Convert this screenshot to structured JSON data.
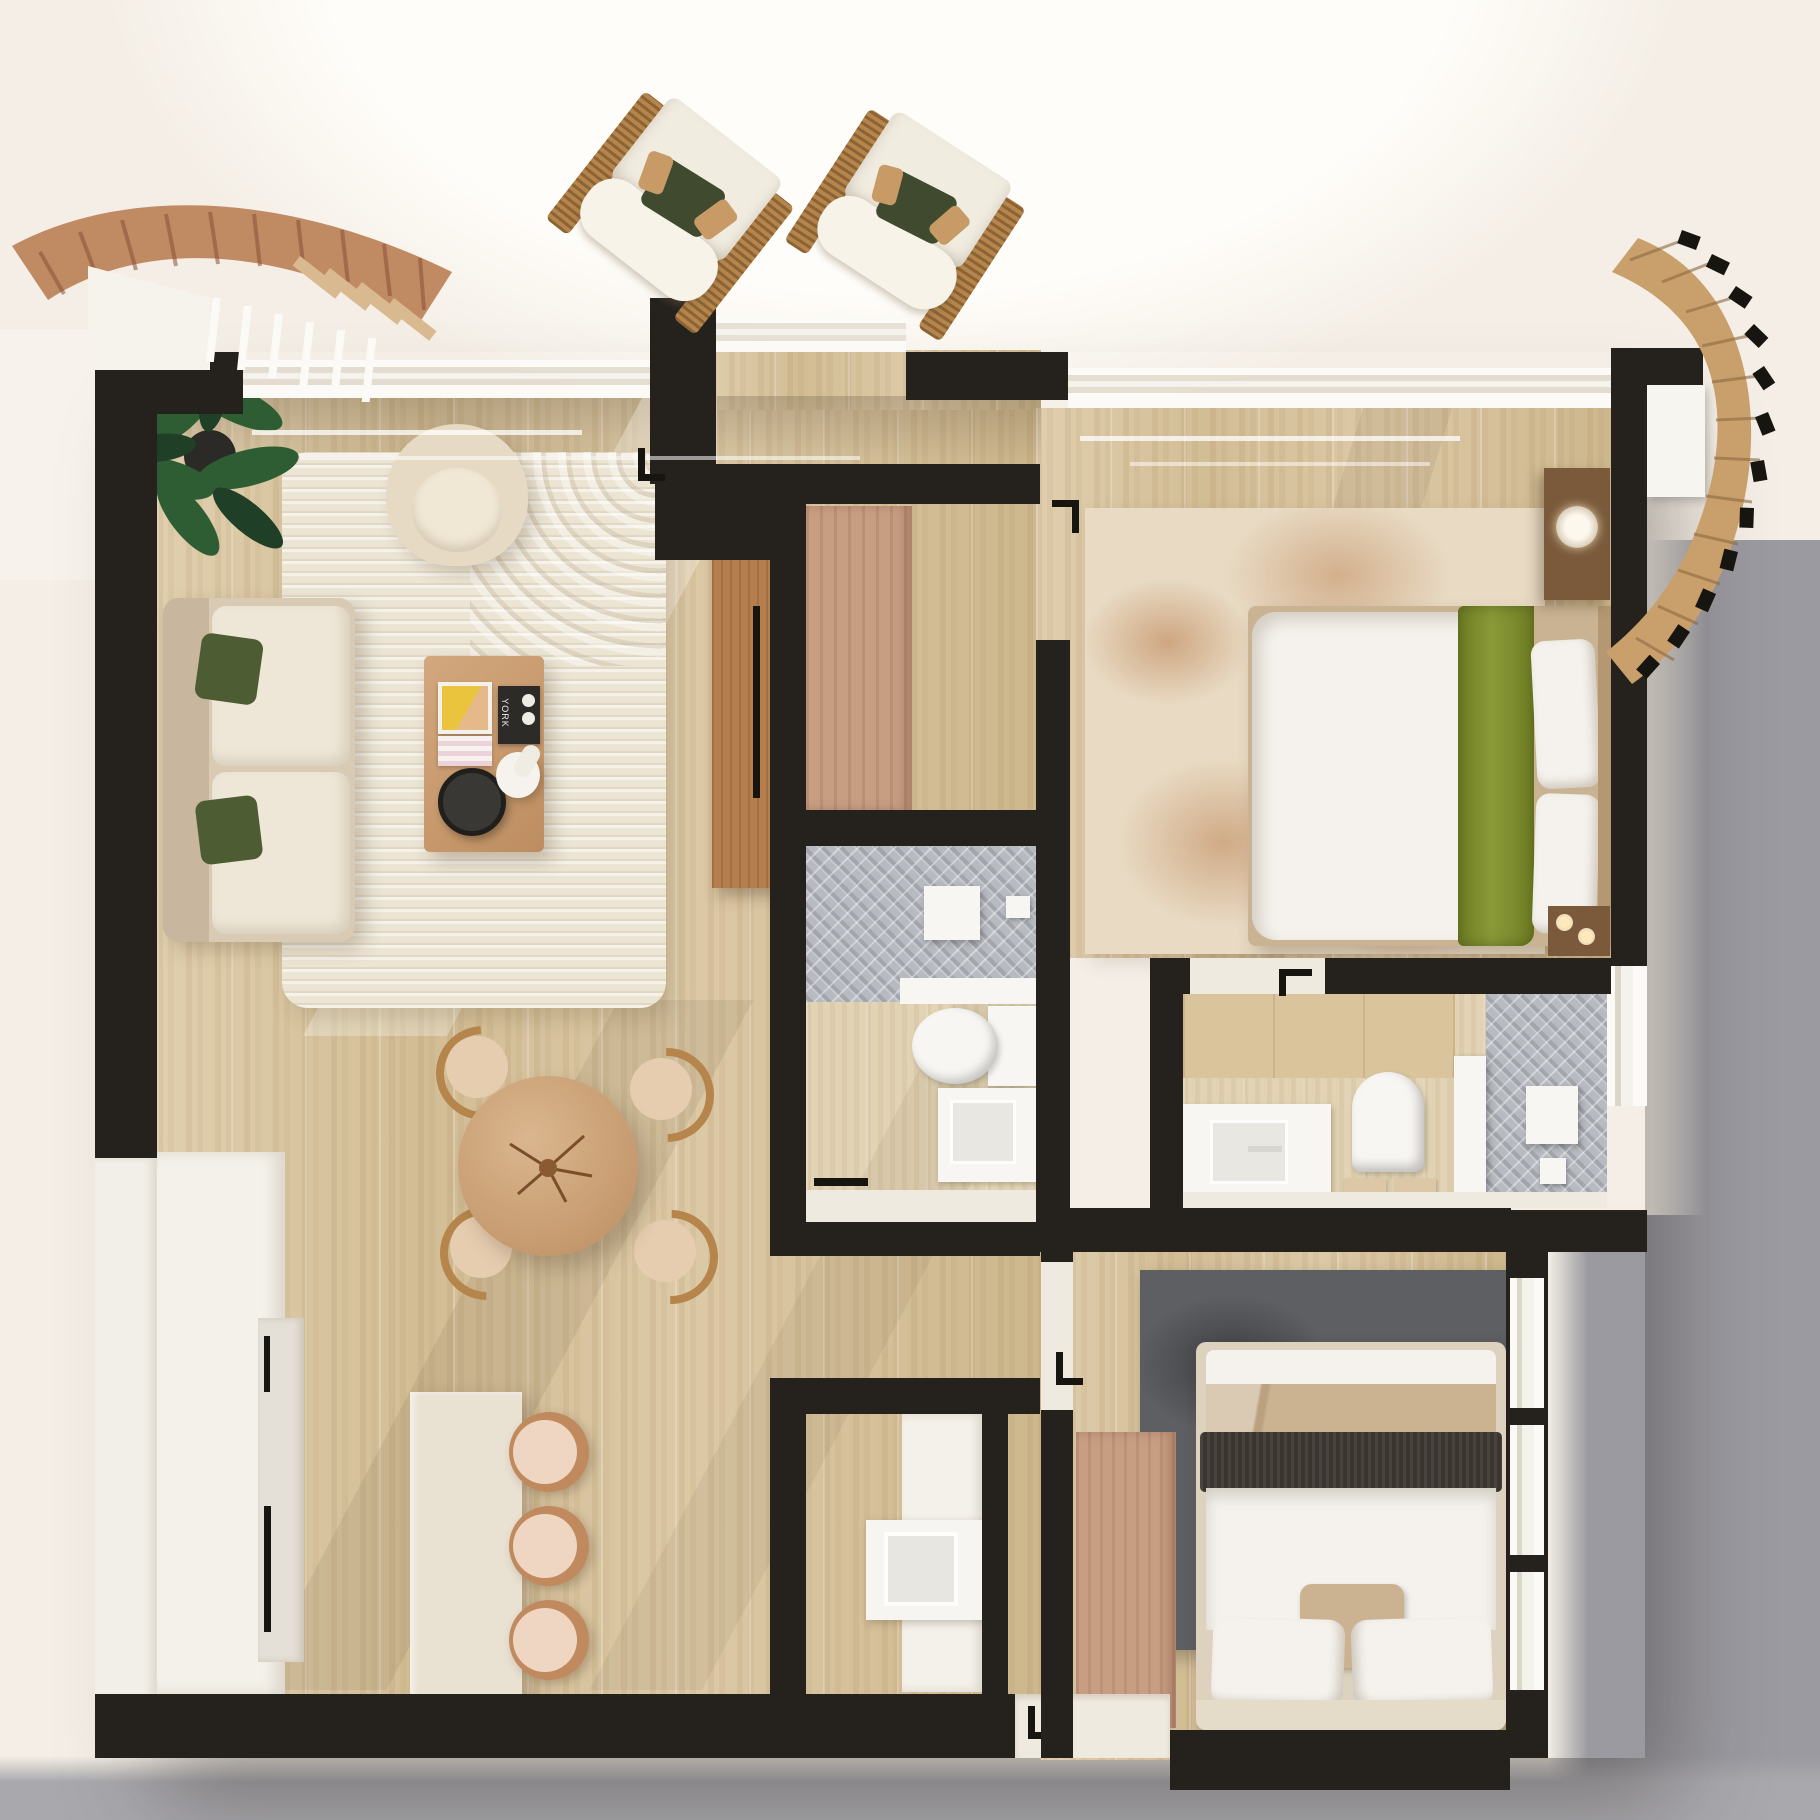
{
  "scene": {
    "kind": "3d-floor-plan-render",
    "view": "top-down",
    "style": "warm minimal apartment"
  },
  "decor": {
    "magazine_title": "YORK"
  },
  "palette": {
    "bg_top": "#f4eee6",
    "bg_glow": "#fffdf9",
    "bg_gray": "#9b9aa0",
    "bg_gray2": "#a9a8ad",
    "wall": "#25221e",
    "wall_white": "#f2efe8",
    "herring": "#b7bac0",
    "rug_living": "#ece5d4",
    "rug_master": "#e8dac3",
    "rug_dark": "#5d5f62",
    "sofa": "#d9cab3",
    "cushion": "#eee7d7",
    "pillow_green": "#4e5c33",
    "wood_table": "#c79a71",
    "wood_console": "#b57e4e",
    "rattan": "#b5854b",
    "island": "#e9e1d2",
    "cabinet": "#f4f1ea",
    "wardrobe": "#c89e83",
    "bed_white": "#f5f2ed",
    "throw_green": "#79892c",
    "bed2_beige": "#cbb392",
    "bed2_dark": "#3a352f",
    "nightstand": "#7a5a3b",
    "terracotta": "#c08a63",
    "fixture": "#f7f6f3",
    "plant_green": "#2e5c33",
    "plant_dark": "#1f4026"
  }
}
